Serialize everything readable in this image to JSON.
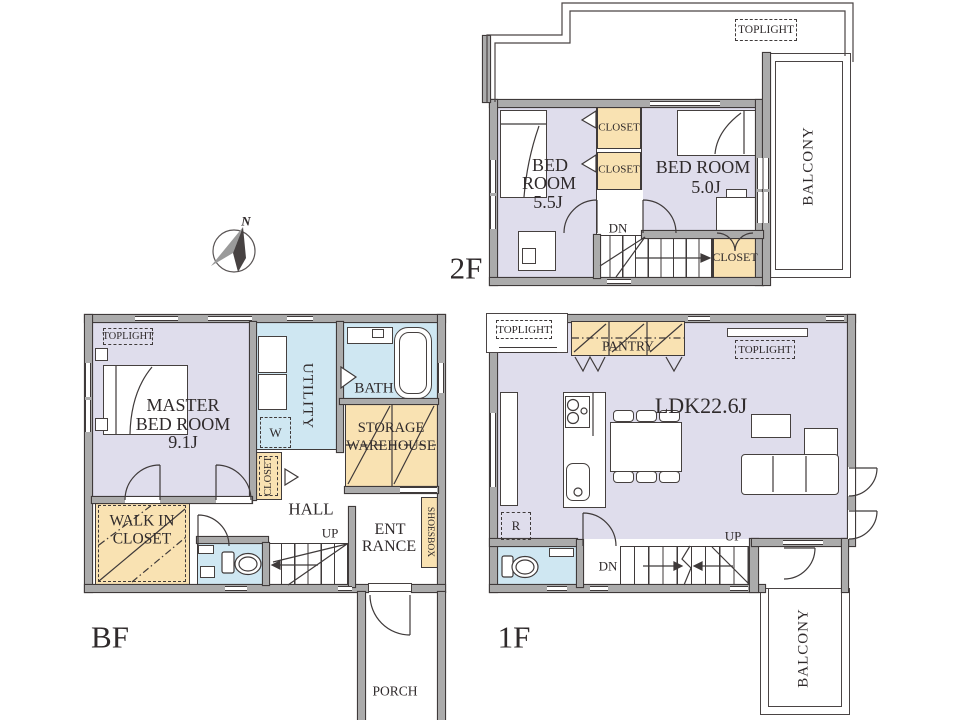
{
  "colors": {
    "room_fill": "#dfddec",
    "closet_fill": "#f9e2b2",
    "wet_area_fill": "#cfe7f2",
    "wall_fill": "#ababab",
    "line": "#3f3a3a"
  },
  "compass": {
    "north_label": "N"
  },
  "f2": {
    "floor_label": "2F",
    "toplight_label": "TOPLIGHT",
    "closet_a": "CLOSET",
    "closet_b": "CLOSET",
    "closet_c": "CLOSET",
    "bedroom1_line1": "BED",
    "bedroom1_line2": "ROOM",
    "bedroom1_size": "5.5J",
    "bedroom2_name": "BED ROOM",
    "bedroom2_size": "5.0J",
    "down_label": "DN",
    "balcony_label": "BALCONY"
  },
  "f1": {
    "floor_label": "1F",
    "toplight_left": "TOPLIGHT",
    "toplight_right": "TOPLIGHT",
    "pantry_label": "PANTRY",
    "ldk_label": "LDK22.6J",
    "fridge_label": "R",
    "up_label": "UP",
    "down_label": "DN",
    "balcony_label": "BALCONY"
  },
  "bf": {
    "floor_label": "BF",
    "toplight_label": "TOPLIGHT",
    "master_line1": "MASTER",
    "master_line2": "BED ROOM",
    "master_size": "9.1J",
    "utility_label": "UTILITY",
    "bath_label": "BATH",
    "washer_label": "W",
    "storage_line1": "STORAGE",
    "storage_line2": "WAREHOUSE",
    "closet_label": "CLOSET",
    "hall_label": "HALL",
    "up_label": "UP",
    "wic_line1": "WALK IN",
    "wic_line2": "CLOSET",
    "entrance_line1": "ENT",
    "entrance_line2": "RANCE",
    "shoesbox_label": "SHOESBOX",
    "porch_label": "PORCH"
  }
}
